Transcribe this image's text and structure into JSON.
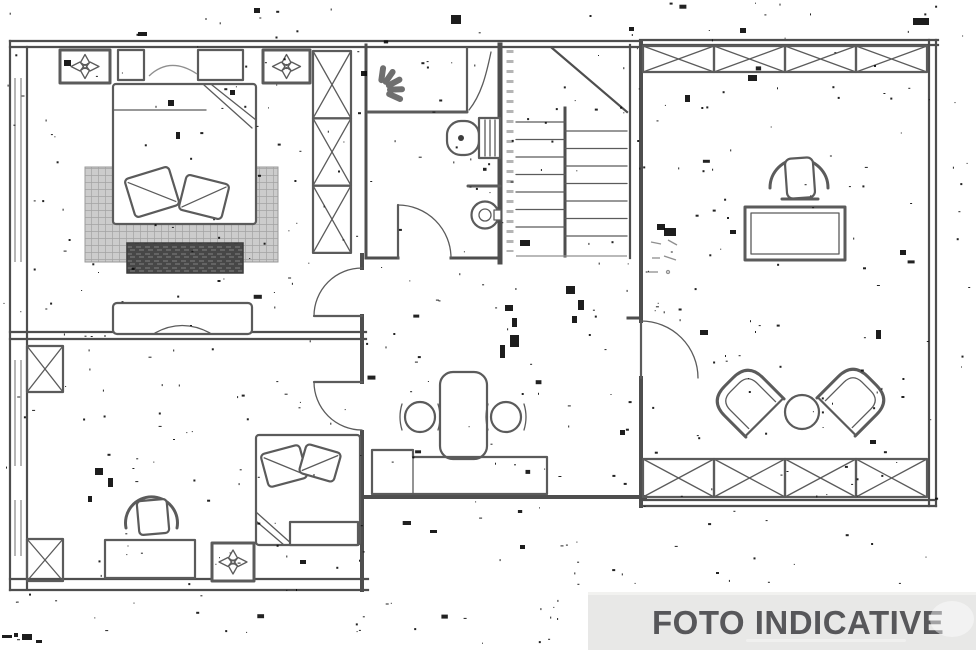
{
  "banner": {
    "label": "FOTO INDICATIVE",
    "background": "#e8e8e7",
    "text_color": "#57575a"
  },
  "plan": {
    "background": "#ffffff",
    "wall_color": "#4e4e4e",
    "furniture_color": "#5b5b5b",
    "light_line_color": "#8f8f8f",
    "noise_color": "#0a0a0a",
    "rug_fill": "#cccccc",
    "rug_line": "#a3a3a3",
    "bench_fill": "#474747",
    "bench_line": "#6e6e6e",
    "shower_spray_color": "#6f6f6f"
  },
  "icons": {
    "ceiling_light": "four-point-star-in-square",
    "shower_spray": "fan-wedges",
    "railing": "x-cross-panels",
    "wardrobe": "x-cross-column",
    "door": "quarter-circle-swing",
    "stairs": "parallel-treads"
  },
  "rooms": [
    {
      "name": "bedroom-upper-left",
      "items": [
        "double-bed",
        "two-pillows",
        "area-rug",
        "bench",
        "sideboard",
        "nightstand-left",
        "nightstand-right",
        "ceiling-light",
        "ceiling-light",
        "wardrobe"
      ]
    },
    {
      "name": "bathroom",
      "items": [
        "shower",
        "toilet",
        "washbasin",
        "door"
      ]
    },
    {
      "name": "staircase",
      "items": [
        "two-flights-of-steps"
      ]
    },
    {
      "name": "hall-kitchen",
      "items": [
        "island-table",
        "stool",
        "stool",
        "counter",
        "doors"
      ]
    },
    {
      "name": "bedroom-lower-left",
      "items": [
        "single-bed",
        "two-pillows",
        "chair",
        "desk",
        "ceiling-light",
        "side-shelf"
      ]
    },
    {
      "name": "living-terrace",
      "items": [
        "chair",
        "table",
        "armchair",
        "armchair",
        "round-side-table",
        "railing-top",
        "railing-bottom",
        "door",
        "dimension-note"
      ]
    }
  ],
  "annotation": {
    "dimension_note": "illegible"
  }
}
